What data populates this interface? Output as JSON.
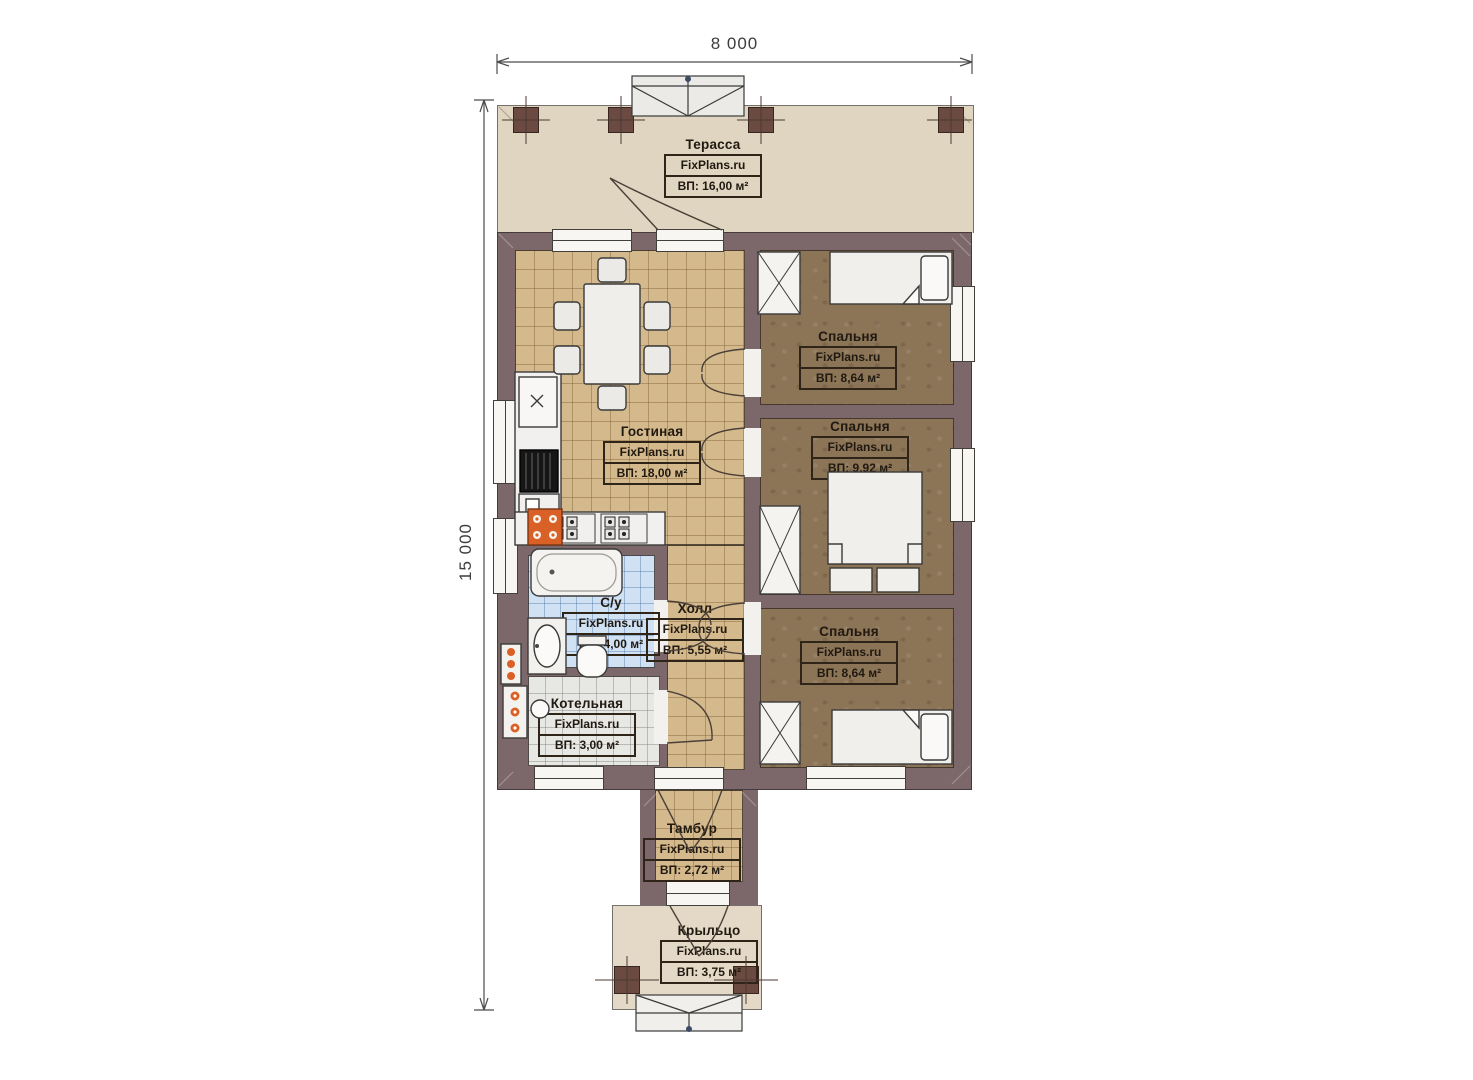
{
  "plan": {
    "brand": "FixPlans.ru",
    "dimensions": {
      "width_label": "8 000",
      "height_label": "15 000"
    },
    "rooms": [
      {
        "id": "terrace",
        "name": "Терасса",
        "brand": "FixPlans.ru",
        "area": "ВП: 16,00 м²"
      },
      {
        "id": "living-room",
        "name": "Гостиная",
        "brand": "FixPlans.ru",
        "area": "ВП: 18,00 м²"
      },
      {
        "id": "bedroom-top",
        "name": "Спальня",
        "brand": "FixPlans.ru",
        "area": "ВП: 8,64 м²"
      },
      {
        "id": "bedroom-middle",
        "name": "Спальня",
        "brand": "FixPlans.ru",
        "area": "ВП: 9,92 м²"
      },
      {
        "id": "bedroom-bottom",
        "name": "Спальня",
        "brand": "FixPlans.ru",
        "area": "ВП: 8,64 м²"
      },
      {
        "id": "bathroom",
        "name": "С/у",
        "brand": "FixPlans.ru",
        "area": "ВП: 4,00 м²"
      },
      {
        "id": "hall",
        "name": "Холл",
        "brand": "FixPlans.ru",
        "area": "ВП: 5,55 м²"
      },
      {
        "id": "boiler-room",
        "name": "Котельная",
        "brand": "FixPlans.ru",
        "area": "ВП: 3,00 м²"
      },
      {
        "id": "vestibule",
        "name": "Тамбур",
        "brand": "FixPlans.ru",
        "area": "ВП: 2,72 м²"
      },
      {
        "id": "porch",
        "name": "Крыльцо",
        "brand": "FixPlans.ru",
        "area": "ВП: 3,75 м²"
      }
    ],
    "colors": {
      "wall": "#7c686a",
      "terrace_floor": "#e0d5c1",
      "porch_floor": "#e3d9c6",
      "wood_floor": "#d4b98d",
      "bedroom_floor": "#8c7457",
      "bathroom_tile": "#cfe1f3",
      "boiler_tile": "#e7e7e4",
      "column": "#6a4a41",
      "radiator": "#d96127",
      "dimension_ink": "#3d3d3d",
      "label_ink": "#201910"
    }
  }
}
